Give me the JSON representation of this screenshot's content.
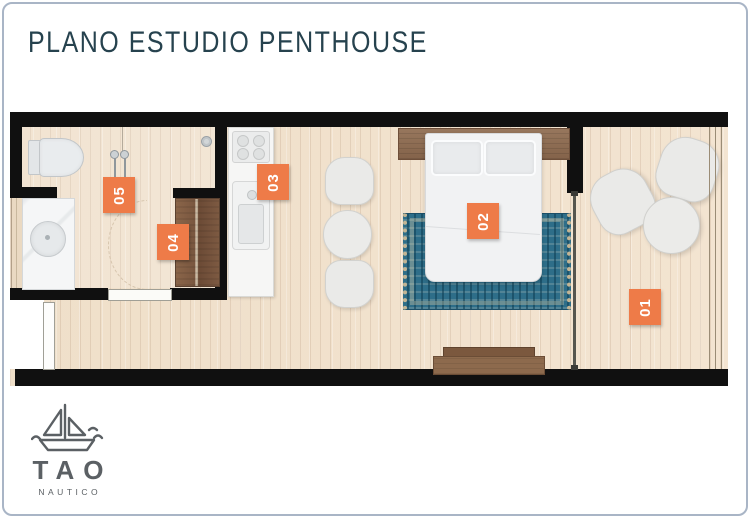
{
  "header": {
    "title": "PLANO ESTUDIO PENTHOUSE"
  },
  "plan": {
    "labels": [
      {
        "number": "01"
      },
      {
        "number": "02"
      },
      {
        "number": "03"
      },
      {
        "number": "04"
      },
      {
        "number": "05"
      }
    ]
  },
  "logo": {
    "brand": "TAO",
    "subtitle": "NAUTICO"
  },
  "colors": {
    "accent_orange": "#EE7B48",
    "wall_black": "#101010",
    "title_teal": "#26424E",
    "rug_teal": "#2E6E89",
    "wood_brown": "#8A684C",
    "floor_beige": "#F0E1CD",
    "frame_gray": "#A9B5C6",
    "logo_gray": "#5B6064"
  }
}
